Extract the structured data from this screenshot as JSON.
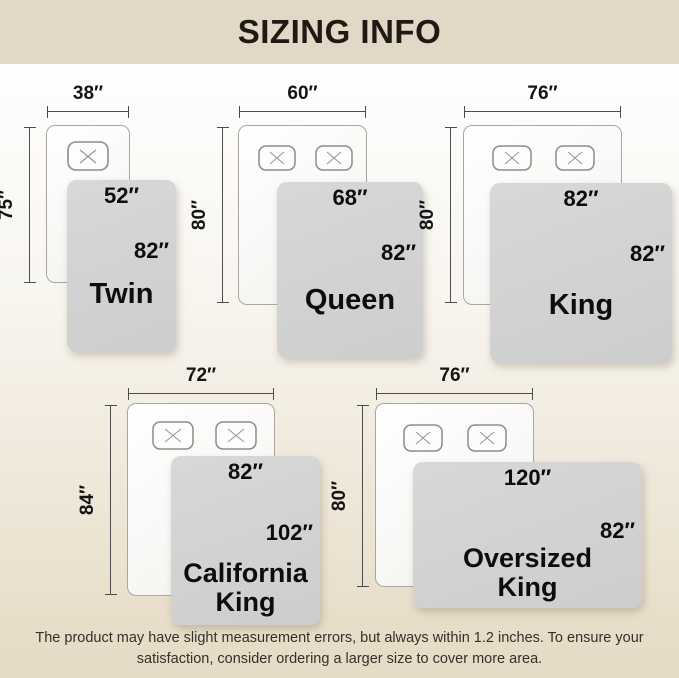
{
  "header": {
    "title": "SIZING INFO"
  },
  "diagrams": [
    {
      "name": "Twin",
      "bed_width": "38″",
      "bed_length": "75″",
      "blanket_width": "52″",
      "blanket_length": "82″"
    },
    {
      "name": "Queen",
      "bed_width": "60″",
      "bed_length": "80″",
      "blanket_width": "68″",
      "blanket_length": "82″"
    },
    {
      "name": "King",
      "bed_width": "76″",
      "bed_length": "80″",
      "blanket_width": "82″",
      "blanket_length": "82″"
    },
    {
      "name": "California King",
      "bed_width": "72″",
      "bed_length": "84″",
      "blanket_width": "82″",
      "blanket_length": "102″"
    },
    {
      "name": "Oversized King",
      "bed_width": "76″",
      "bed_length": "80″",
      "blanket_width": "120″",
      "blanket_length": "82″"
    }
  ],
  "footer": {
    "line1": "The product may have slight measurement errors, but always within 1.2 inches. To ensure your",
    "line2": "satisfaction, consider ordering a larger size to cover more area."
  },
  "colors": {
    "banner": "#e3d7c5",
    "background_bottom": "#e6dbc6",
    "blanket": "#d3d3d3",
    "text": "#0d0d0d"
  }
}
